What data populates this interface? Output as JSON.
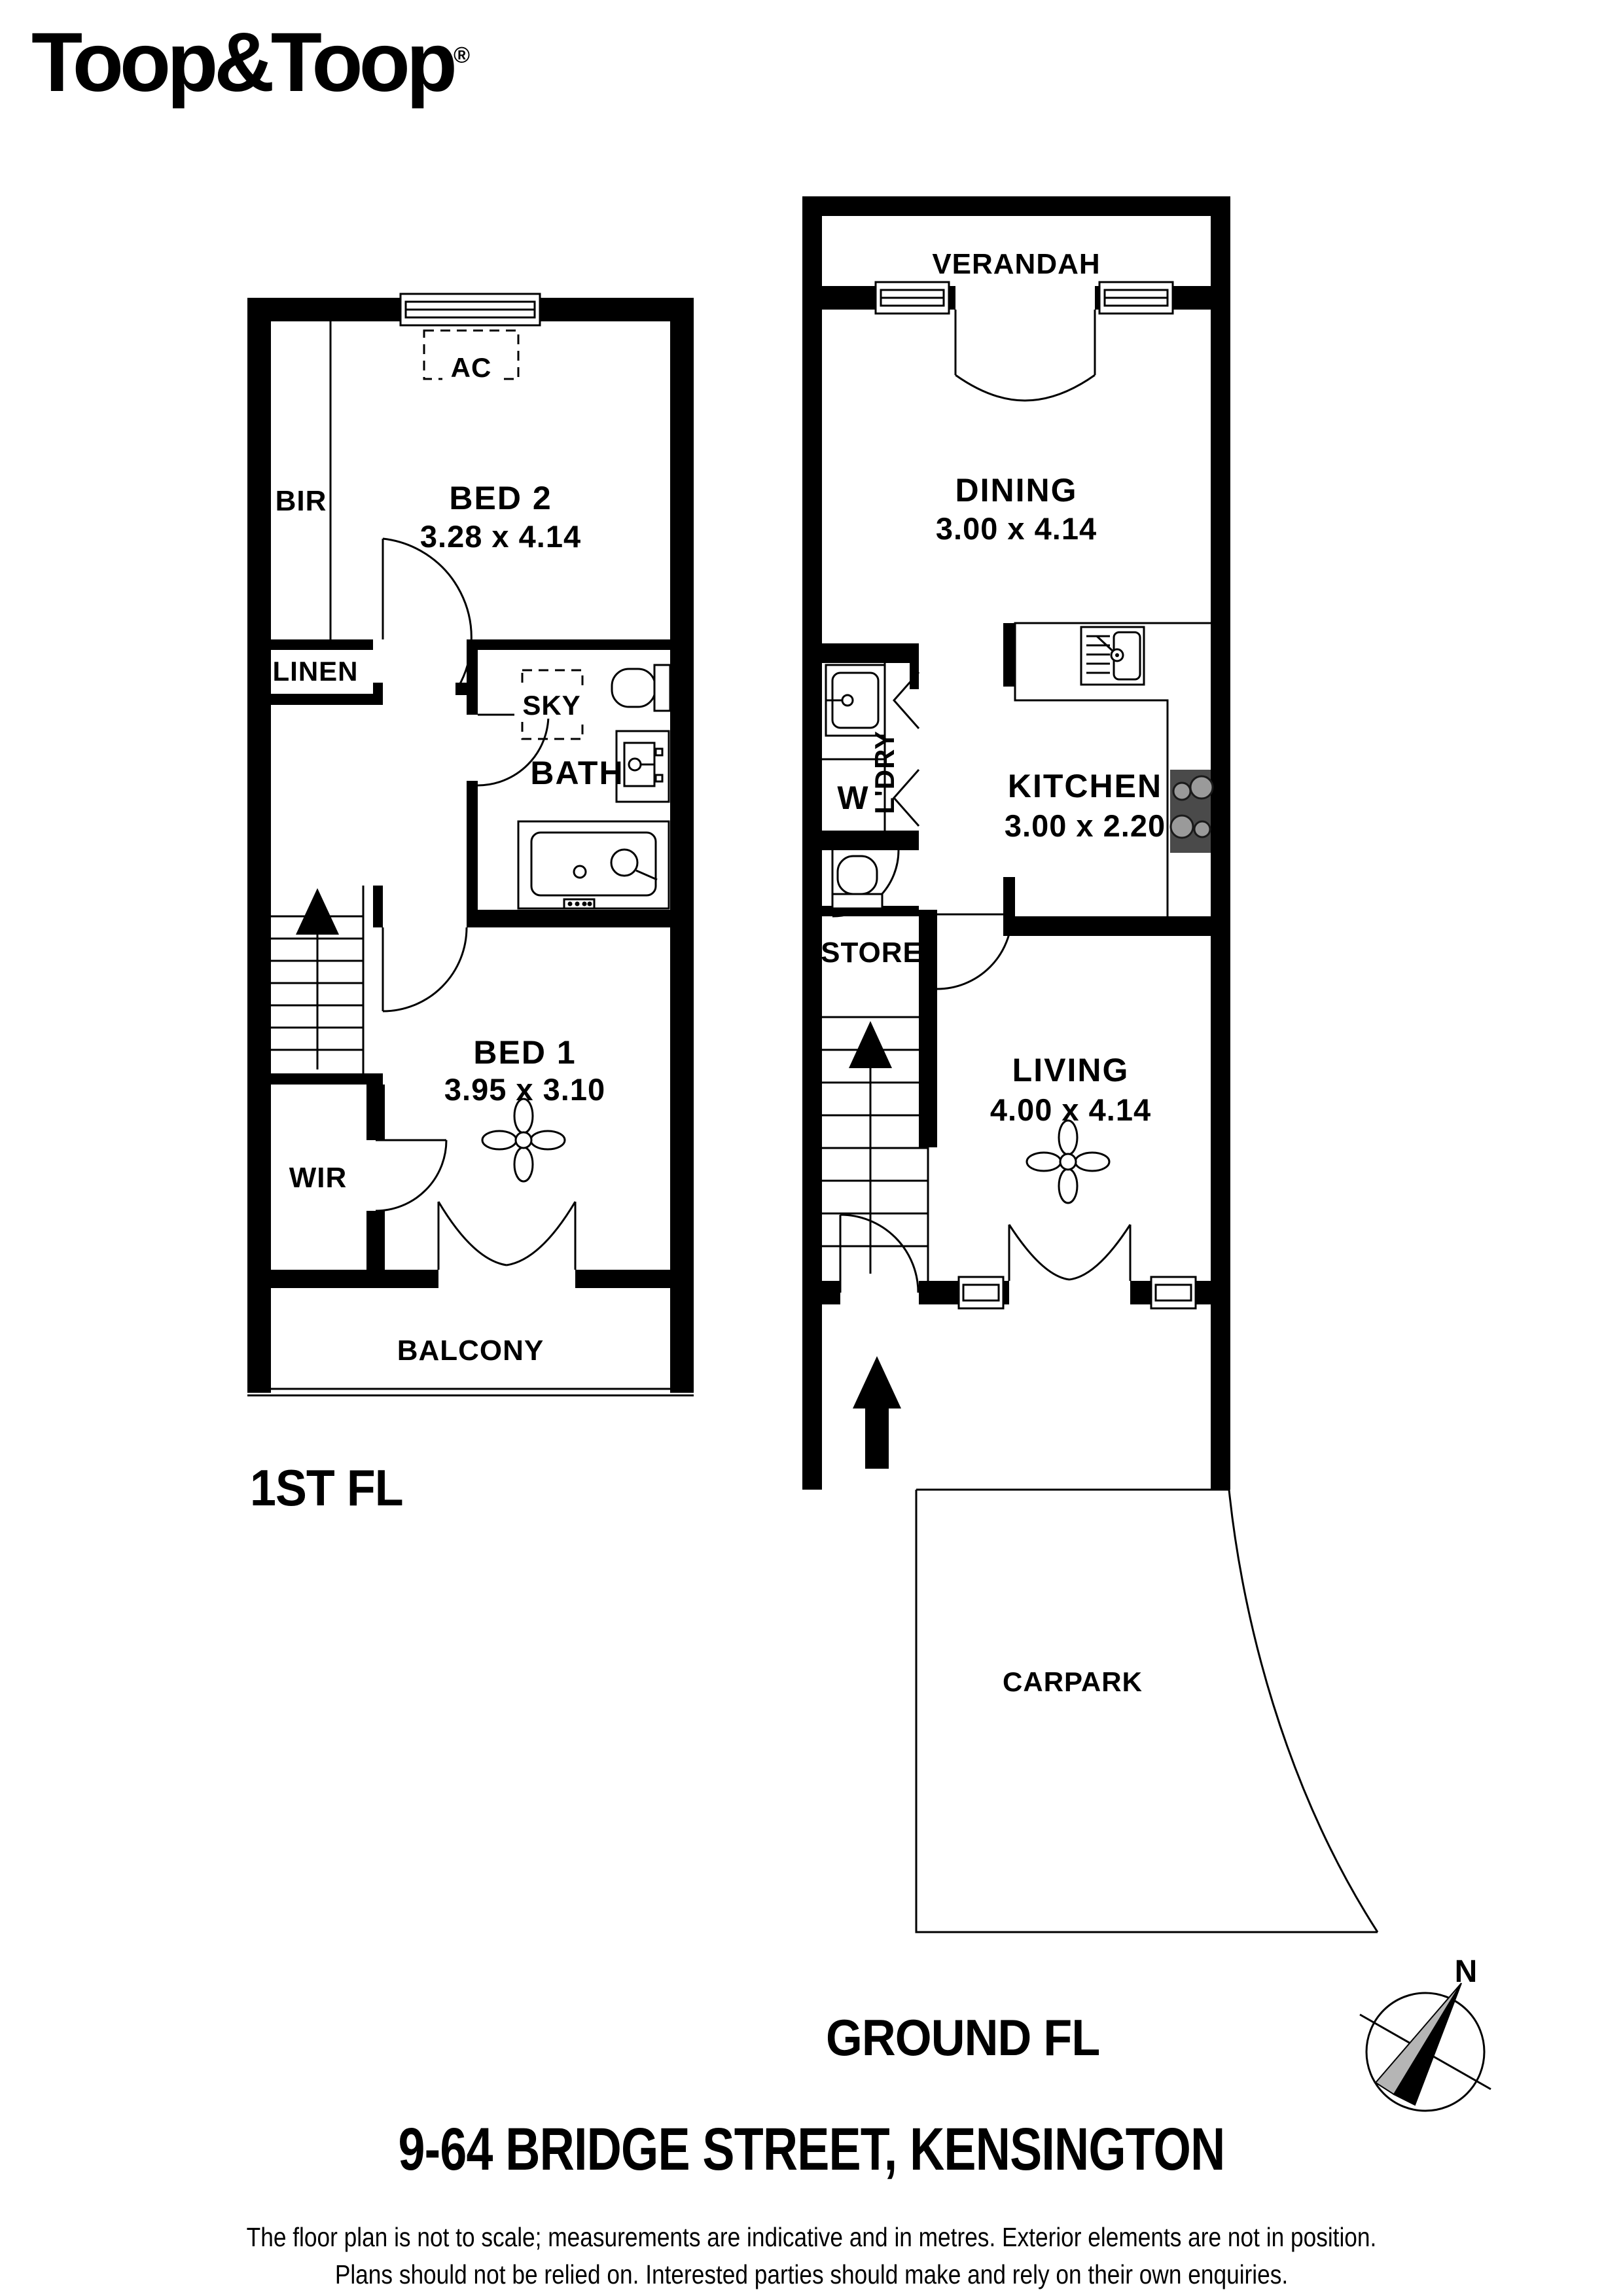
{
  "logo": {
    "text": "Toop&Toop",
    "registered": "®"
  },
  "first_floor": {
    "title": "1ST FL",
    "labels": {
      "ac": "AC",
      "bir": "BIR",
      "bed2_name": "BED 2",
      "bed2_dims": "3.28 x 4.14",
      "linen": "LINEN",
      "sky": "SKY",
      "bath": "BATH",
      "bed1_name": "BED 1",
      "bed1_dims": "3.95 x 3.10",
      "wir": "WIR",
      "balcony": "BALCONY"
    }
  },
  "ground_floor": {
    "title": "GROUND FL",
    "labels": {
      "verandah": "VERANDAH",
      "dining_name": "DINING",
      "dining_dims": "3.00 x 4.14",
      "laundry": "L'DRY",
      "washer": "W",
      "kitchen_name": "KITCHEN",
      "kitchen_dims": "3.00 x 2.20",
      "store": "STORE",
      "living_name": "LIVING",
      "living_dims": "4.00 x 4.14",
      "carpark": "CARPARK"
    }
  },
  "compass": {
    "north": "N"
  },
  "footer": {
    "address": "9-64 BRIDGE STREET, KENSINGTON",
    "disclaimer_line1": "The floor plan is not to scale; measurements are indicative and in metres. Exterior elements are not in position.",
    "disclaimer_line2": "Plans should not be relied on. Interested parties should make and rely on their own enquiries."
  },
  "colors": {
    "wall": "#000000",
    "line": "#000000",
    "cooktop": "#4a4a4a",
    "burner": "#9a9a9a",
    "compass_gray": "#b5b5b5",
    "background": "#ffffff"
  }
}
